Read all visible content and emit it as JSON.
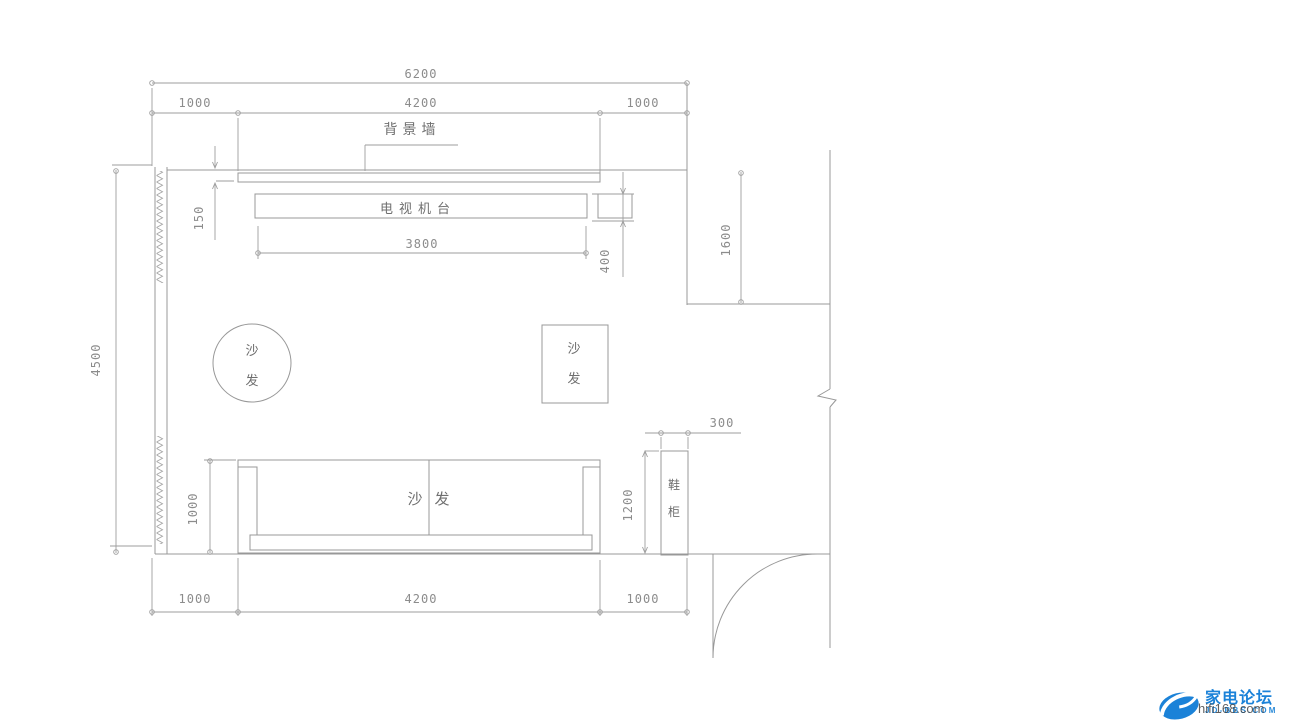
{
  "canvas": {
    "background": "#ffffff",
    "line_color": "#989898",
    "dim_text_color": "#8c8c8c",
    "label_color": "#6f6f6f",
    "logo_blue": "#1b82d8",
    "watermark_gray": "#3c3c3c"
  },
  "dimensions": {
    "top_total": "6200",
    "top_left": "1000",
    "top_mid": "4200",
    "top_right": "1000",
    "bgwall_thickness": "150",
    "tv_width": "3800",
    "tv_depth": "400",
    "alcove_height": "1600",
    "room_height": "4500",
    "sofa_depth": "1000",
    "shoe_cabinet_height": "1200",
    "shoe_cabinet_width": "300",
    "bottom_left": "1000",
    "bottom_mid": "4200",
    "bottom_right": "1000"
  },
  "labels": {
    "background_wall": "背景墙",
    "tv_stand": "电视机台",
    "sofa_round_top": "沙",
    "sofa_round_bottom": "发",
    "sofa_square_top": "沙",
    "sofa_square_bottom": "发",
    "sofa_main_left": "沙",
    "sofa_main_right": "发",
    "shoe_top": "鞋",
    "shoe_bottom": "柜"
  },
  "logo": {
    "brand": "家电论坛",
    "site": "JD-BBS.COM",
    "watermark": "hifi168.com"
  }
}
